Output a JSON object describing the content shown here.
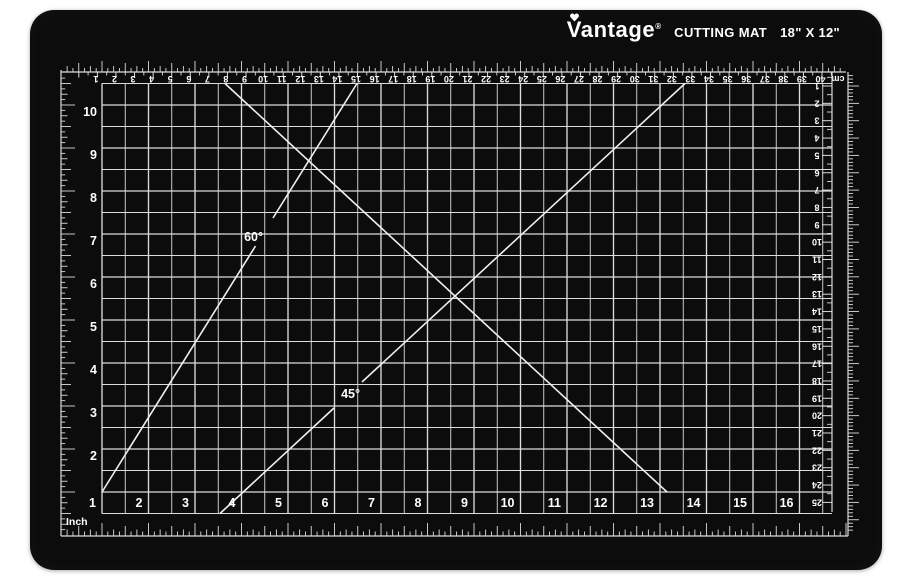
{
  "branding": {
    "logo": "Vantage",
    "registered": "®",
    "product": "CUTTING MAT",
    "dimensions": "18\" X 12\""
  },
  "labels": {
    "bottom_inches": [
      "1",
      "2",
      "3",
      "4",
      "5",
      "6",
      "7",
      "8",
      "9",
      "10",
      "11",
      "12",
      "13",
      "14",
      "15",
      "16"
    ],
    "left_inches": [
      "10",
      "9",
      "8",
      "7",
      "6",
      "5",
      "4",
      "3",
      "2"
    ],
    "top_cm": [
      "40",
      "39",
      "38",
      "37",
      "36",
      "35",
      "34",
      "33",
      "32",
      "31",
      "30",
      "29",
      "28",
      "27",
      "26",
      "25",
      "24",
      "23",
      "22",
      "21",
      "20",
      "19",
      "18",
      "17",
      "16",
      "15",
      "14",
      "13",
      "12",
      "11",
      "10",
      "9",
      "8",
      "7",
      "6",
      "5",
      "4",
      "3",
      "2",
      "1"
    ],
    "right_cm": [
      "1",
      "2",
      "3",
      "4",
      "5",
      "6",
      "7",
      "8",
      "9",
      "10",
      "11",
      "12",
      "13",
      "14",
      "15",
      "16",
      "17",
      "18",
      "19",
      "20",
      "21",
      "22",
      "23",
      "24",
      "25"
    ],
    "unit_inch": "Inch",
    "unit_cm": "cm",
    "angle_60": "60°",
    "angle_45": "45°"
  },
  "colors": {
    "background": "#ffffff",
    "mat": "#0c0c0c",
    "grid_line": "#dcdcdc",
    "diagonal": "#efefef",
    "text": "#ffffff"
  }
}
